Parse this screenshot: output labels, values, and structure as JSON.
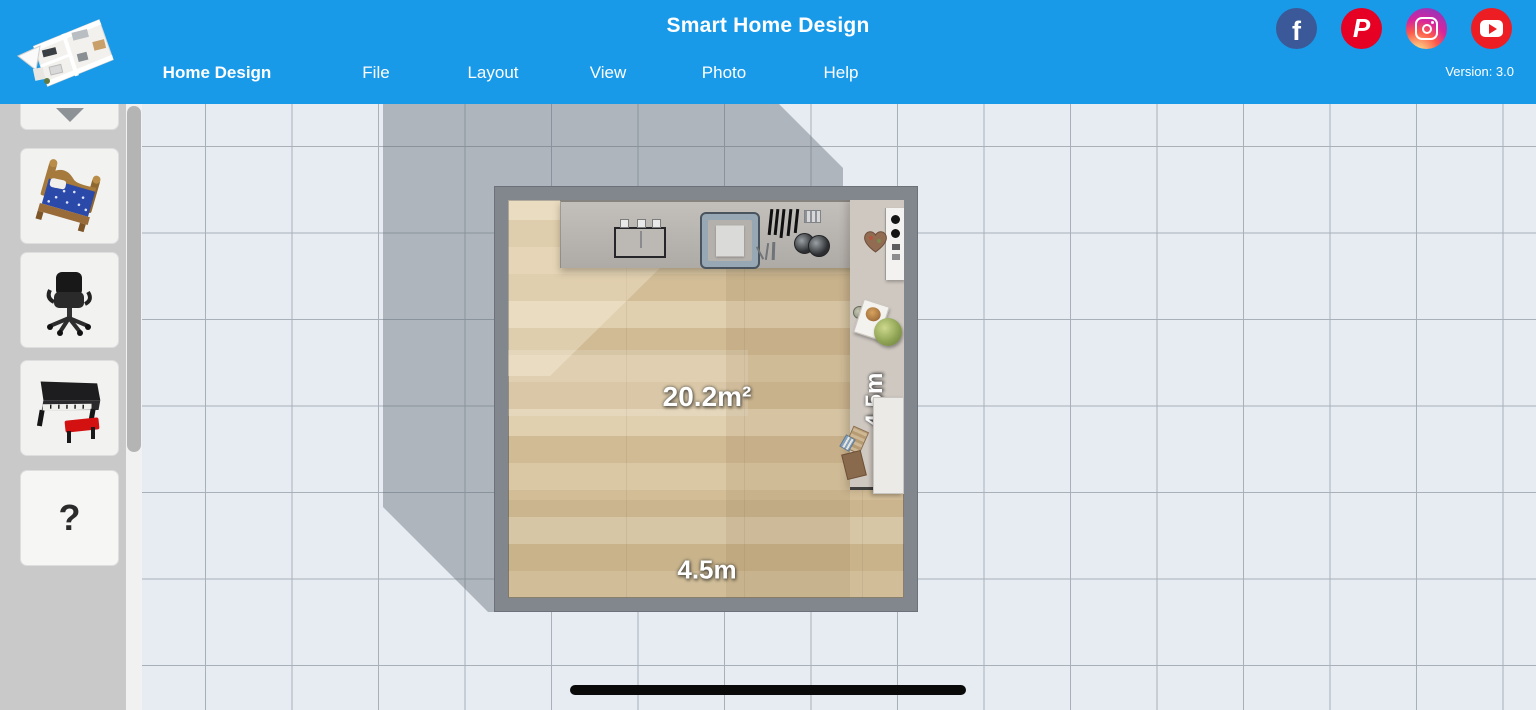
{
  "header": {
    "title": "Smart Home Design",
    "version": "Version: 3.0",
    "menu": [
      {
        "label": "Home Design",
        "active": true
      },
      {
        "label": "File"
      },
      {
        "label": "Layout"
      },
      {
        "label": "View"
      },
      {
        "label": "Photo"
      },
      {
        "label": "Help"
      }
    ],
    "social": [
      {
        "name": "facebook-icon",
        "glyph": "f",
        "color": "#3b5998"
      },
      {
        "name": "pinterest-icon",
        "glyph": "P",
        "color": "#e60023"
      },
      {
        "name": "instagram-icon",
        "color": "gradient"
      },
      {
        "name": "youtube-icon",
        "color": "#ed1d24"
      }
    ]
  },
  "sidebar": {
    "items": [
      {
        "name": "furniture-partial"
      },
      {
        "name": "bed"
      },
      {
        "name": "office-chair"
      },
      {
        "name": "piano"
      },
      {
        "name": "unknown-item",
        "label": "?"
      }
    ]
  },
  "floorplan": {
    "area_label": "20.2m²",
    "width_label": "4.5m",
    "height_label": "4.5m",
    "fixtures": [
      "sink",
      "stove",
      "knife-rack",
      "pots",
      "cabinet",
      "wreath",
      "cutting-board",
      "cabbage",
      "desk"
    ]
  },
  "colors": {
    "accent": "#189ae9",
    "wall": "#82878d",
    "floor": "#d6c29c",
    "grid_line": "#a9b0b8",
    "canvas_bg": "#e7ecf2"
  }
}
